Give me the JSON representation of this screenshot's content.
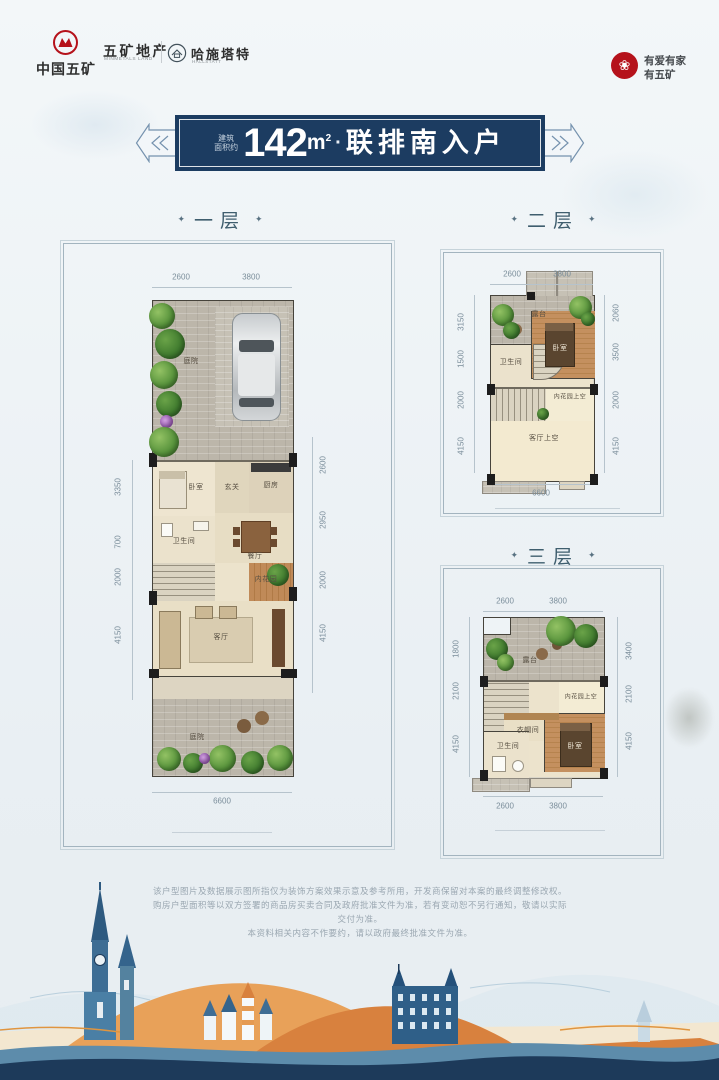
{
  "header": {
    "brand1": {
      "name": "中国五矿"
    },
    "brand2": {
      "name": "五矿地产",
      "sub": "MINMETALS LAND"
    },
    "brand3": {
      "name": "哈施塔特",
      "sub": "HALLSTATT"
    },
    "slogan": {
      "line1": "有爱有家",
      "line2": "有五矿"
    }
  },
  "icons": {
    "love_flower": "❀"
  },
  "ui": {
    "ornament": "✦"
  },
  "banner": {
    "prefix1": "建筑",
    "prefix2": "面积约",
    "area": "142",
    "unit_base": "m",
    "unit_sup": "2",
    "dot": "·",
    "title": "联排南入户"
  },
  "floors": {
    "f1": {
      "title": "一层",
      "rooms": {
        "courtyard_top": "庭院",
        "bedroom": "卧室",
        "foyer": "玄关",
        "kitchen": "厨房",
        "bath": "卫生间",
        "dining": "餐厅",
        "garden": "内花园",
        "living": "客厅",
        "courtyard_bottom": "庭院"
      },
      "dims": {
        "top": [
          "2600",
          "3800"
        ],
        "left": [
          "3350",
          "700",
          "2000",
          "4150"
        ],
        "right": [
          "2600",
          "2950",
          "2000",
          "4150"
        ],
        "bottom": [
          "6600"
        ]
      }
    },
    "f2": {
      "title": "二层",
      "rooms": {
        "terrace": "露台",
        "bedroom": "卧室",
        "bath": "卫生间",
        "garden_void": "内花园上空",
        "living_void": "客厅上空"
      },
      "dims": {
        "top": [
          "2600",
          "3800"
        ],
        "left": [
          "3150",
          "1500",
          "2000",
          "4150"
        ],
        "right": [
          "2060",
          "3500",
          "2000",
          "4150"
        ],
        "bottom": [
          "6600"
        ]
      }
    },
    "f3": {
      "title": "三层",
      "rooms": {
        "terrace": "露台",
        "garden_void": "内花园上空",
        "cloak": "衣帽间",
        "bedroom": "卧室",
        "bath": "卫生间"
      },
      "dims": {
        "top": [
          "2600",
          "3800"
        ],
        "left": [
          "1800",
          "2100",
          "4150"
        ],
        "right": [
          "3400",
          "2100",
          "4150"
        ],
        "bottom": [
          "2600",
          "3800"
        ]
      }
    }
  },
  "disclaimer": {
    "line1": "该户型图片及数据展示图所指仅为装饰方案效果示意及参考所用，开发商保留对本案的最终调整修改权。",
    "line2": "购房户型面积等以双方签署的商品房买卖合同及政府批准文件为准，若有变动恕不另行通知，敬请以实际交付为准。",
    "line3": "本资料相关内容不作要约，请以政府最终批准文件为准。"
  }
}
